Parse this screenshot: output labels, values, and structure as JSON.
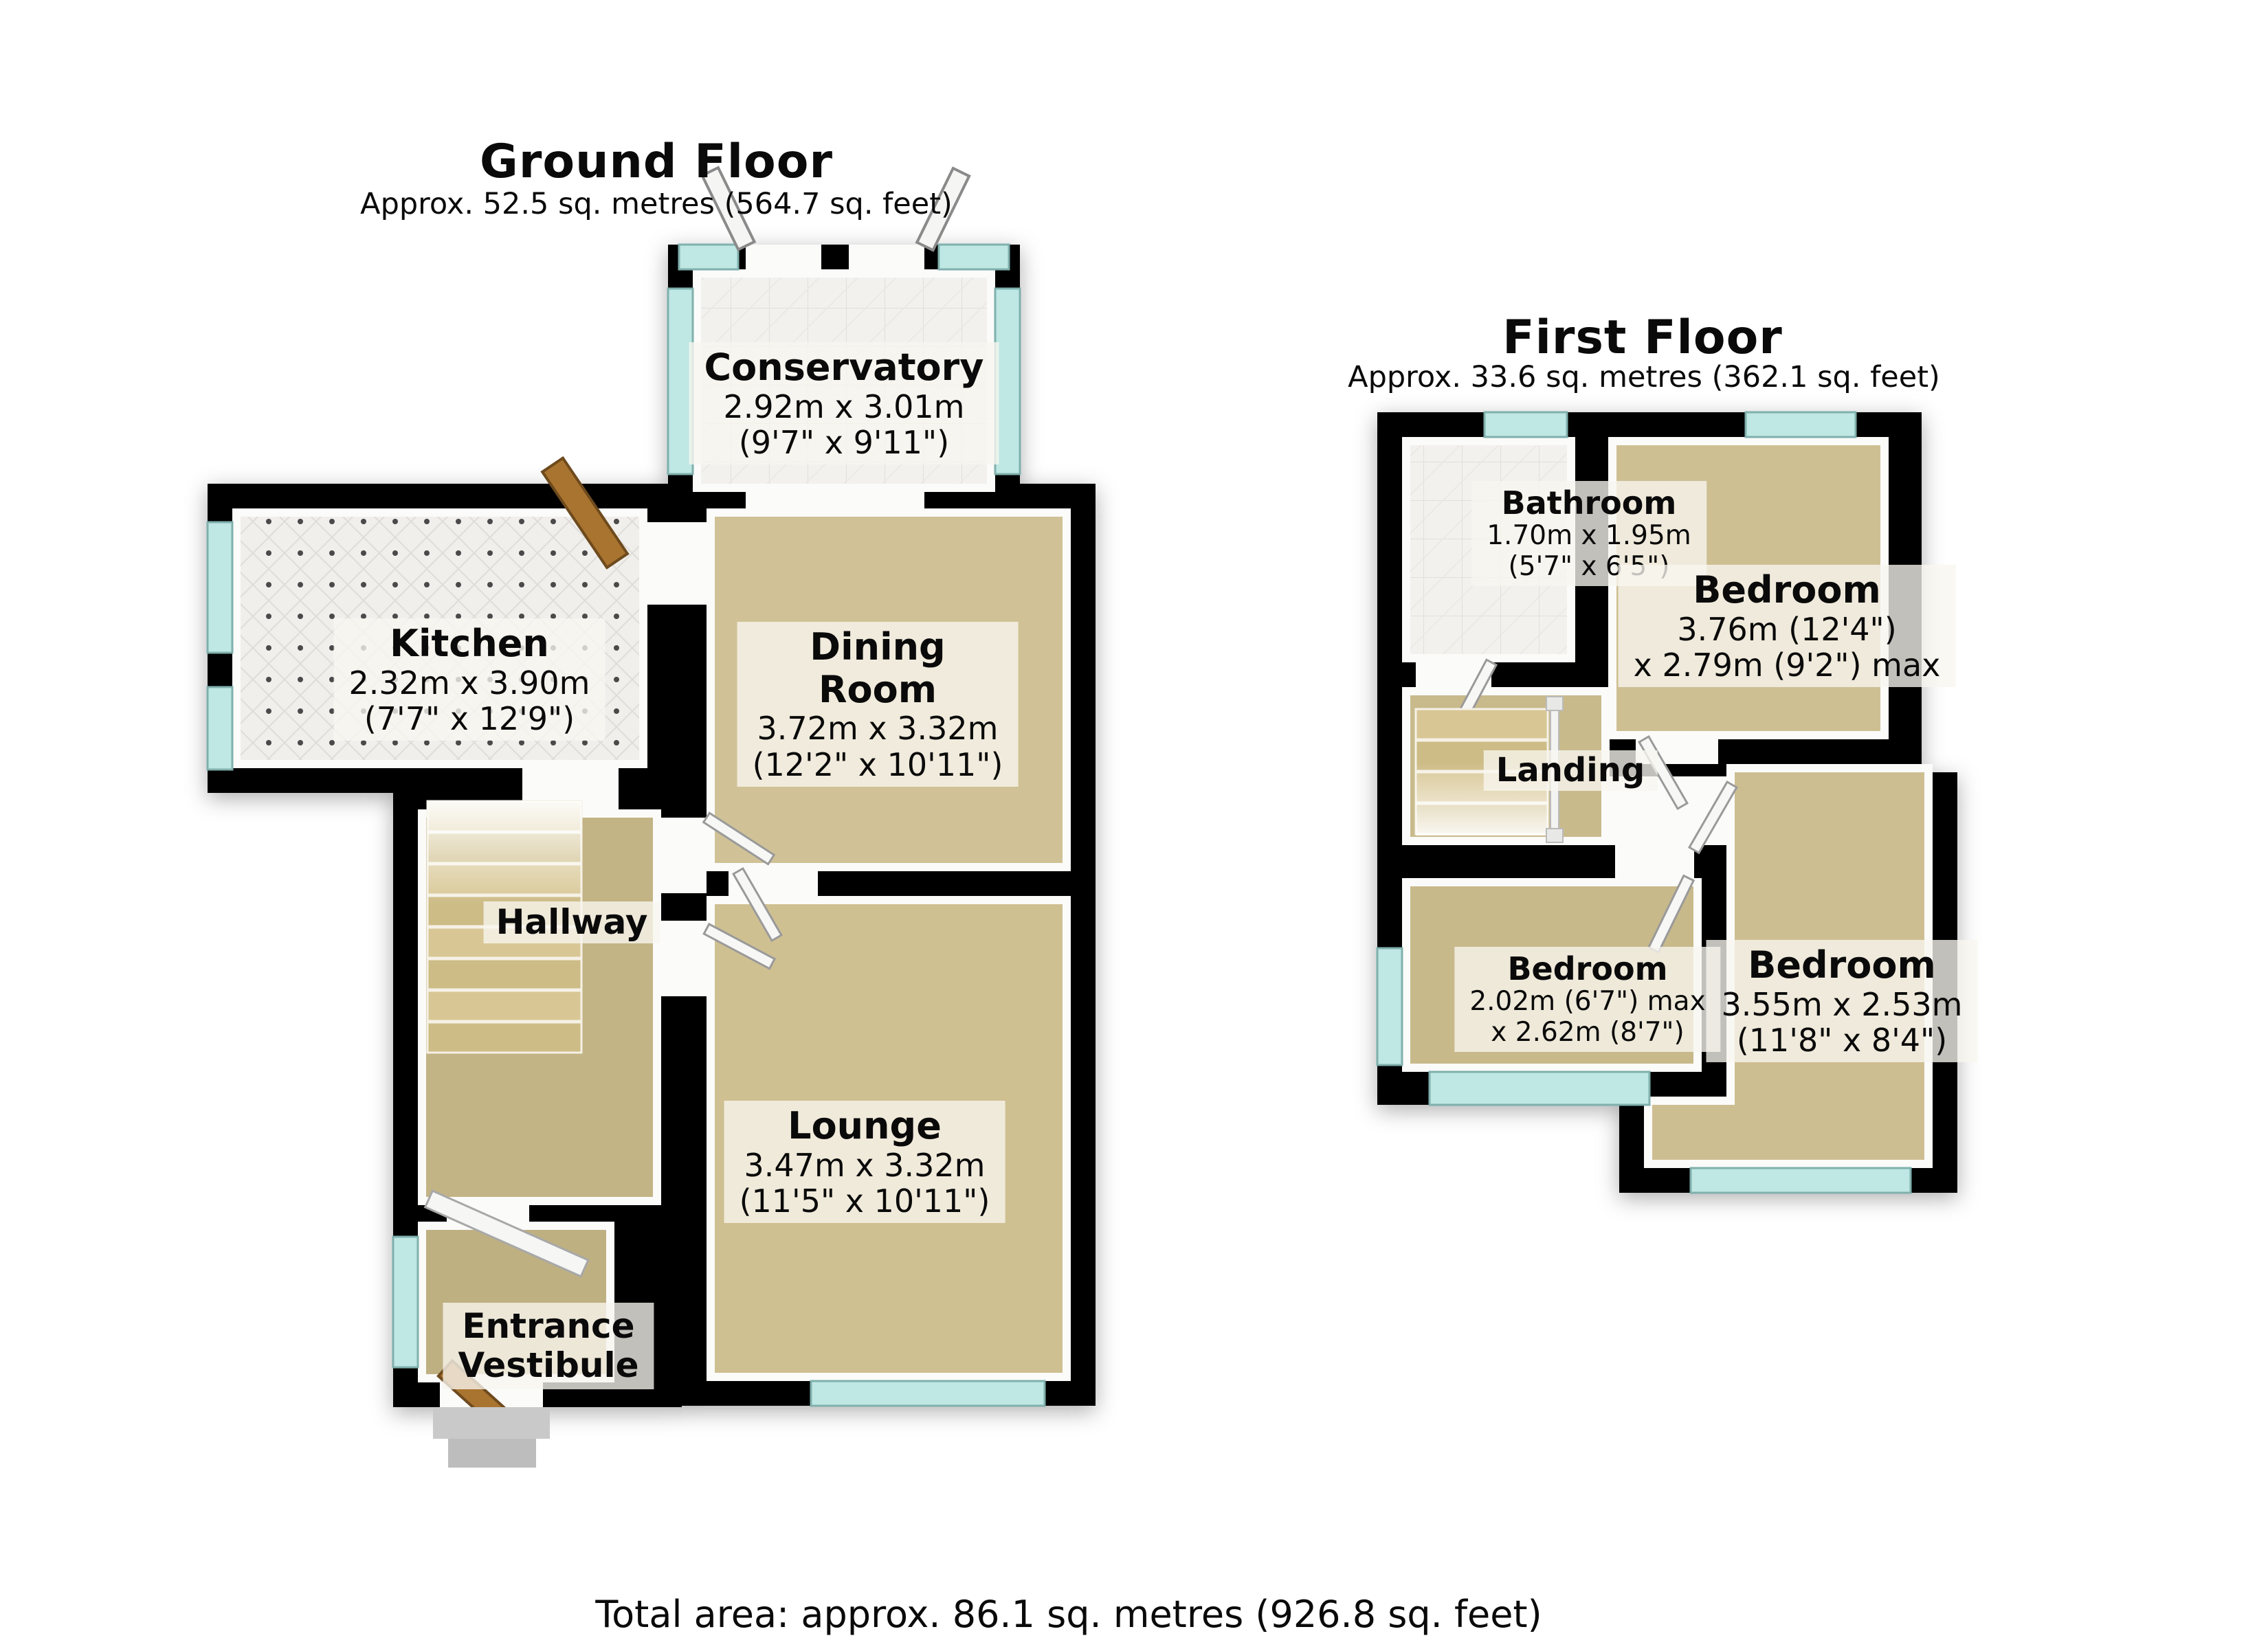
{
  "ground_floor": {
    "title": "Ground Floor",
    "subtitle": "Approx. 52.5 sq. metres (564.7 sq. feet)",
    "rooms": {
      "conservatory": {
        "name": "Conservatory",
        "dims_metric": "2.92m x 3.01m",
        "dims_imperial": "(9'7\" x 9'11\")"
      },
      "kitchen": {
        "name": "Kitchen",
        "dims_metric": "2.32m x 3.90m",
        "dims_imperial": "(7'7\" x 12'9\")"
      },
      "dining_room": {
        "name_line1": "Dining",
        "name_line2": "Room",
        "dims_metric": "3.72m x 3.32m",
        "dims_imperial": "(12'2\" x 10'11\")"
      },
      "hallway": {
        "name": "Hallway"
      },
      "lounge": {
        "name": "Lounge",
        "dims_metric": "3.47m x 3.32m",
        "dims_imperial": "(11'5\" x 10'11\")"
      },
      "entrance_vestibule": {
        "name_line1": "Entrance",
        "name_line2": "Vestibule"
      }
    }
  },
  "first_floor": {
    "title": "First Floor",
    "subtitle": "Approx. 33.6 sq. metres (362.1 sq. feet)",
    "rooms": {
      "bathroom": {
        "name": "Bathroom",
        "dims_metric": "1.70m x 1.95m",
        "dims_imperial": "(5'7\" x 6'5\")"
      },
      "bedroom_rear": {
        "name": "Bedroom",
        "dims_line1": "3.76m (12'4\")",
        "dims_line2": "x 2.79m (9'2\") max"
      },
      "landing": {
        "name": "Landing"
      },
      "bedroom_small": {
        "name": "Bedroom",
        "dims_line1": "2.02m (6'7\") max",
        "dims_line2": "x 2.62m (8'7\")"
      },
      "bedroom_front": {
        "name": "Bedroom",
        "dims_metric": "3.55m x 2.53m",
        "dims_imperial": "(11'8\" x 8'4\")"
      }
    }
  },
  "footer": {
    "total_area": "Total area: approx. 86.1 sq. metres (926.8 sq. feet)"
  },
  "colors": {
    "wall": "#060606",
    "carpet": "#CEC094",
    "carpet_dark": "#C3B485",
    "glass": "#BFE7E3",
    "tile": "#F2F1EE",
    "door_wood": "#A9742F",
    "label_bg": "rgba(248,246,240,0.78)"
  }
}
